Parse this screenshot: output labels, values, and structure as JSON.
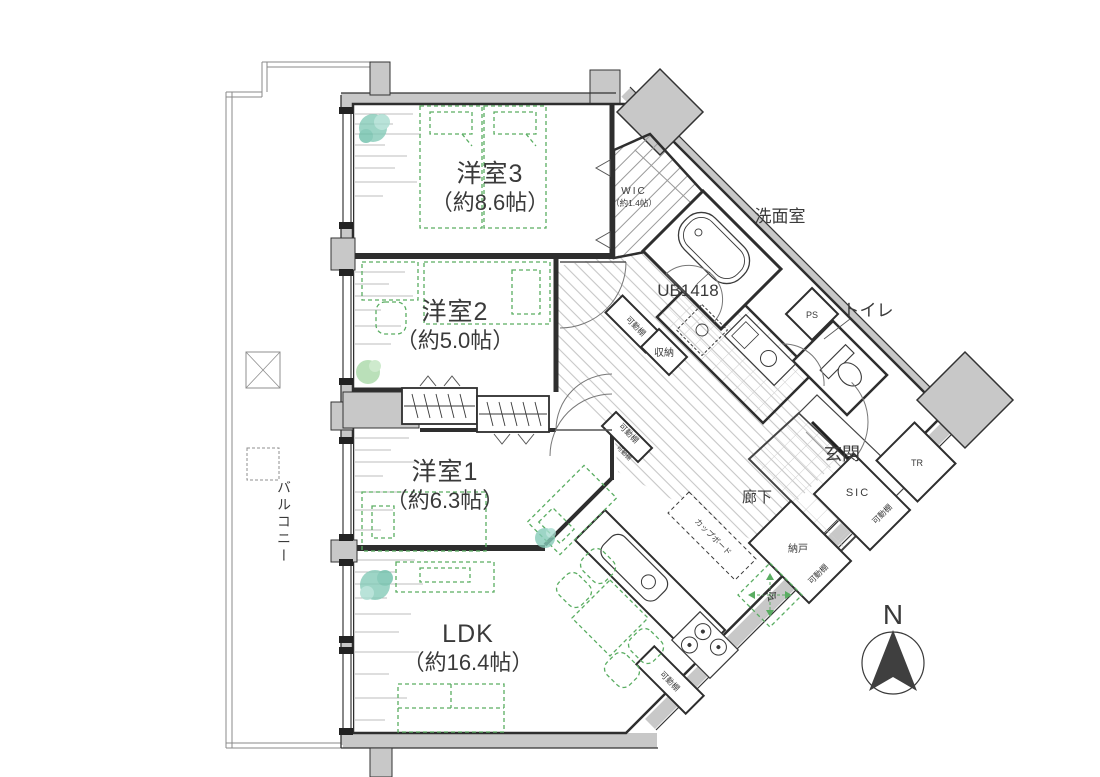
{
  "plan": {
    "rooms": {
      "yoshitsu3": {
        "name": "洋室3",
        "size": "（約8.6帖）"
      },
      "yoshitsu2": {
        "name": "洋室2",
        "size": "（約5.0帖）"
      },
      "yoshitsu1": {
        "name": "洋室1",
        "size": "（約6.3帖）"
      },
      "ldk": {
        "name": "LDK",
        "size": "（約16.4帖）"
      },
      "wic": {
        "name": "WIC",
        "size": "（約1.4帖）"
      },
      "senmenshitsu": {
        "name": "洗面室"
      },
      "bath": {
        "name": "UB1418"
      },
      "toilet": {
        "name": "トイレ"
      },
      "genkan": {
        "name": "玄関"
      },
      "rouka": {
        "name": "廊下"
      },
      "sic": {
        "name": "SIC"
      },
      "nando": {
        "name": "納戸"
      },
      "balcony": {
        "name": "バルコニー"
      }
    },
    "labels": {
      "ps": "PS",
      "tr": "TR",
      "shunou": "収納",
      "kadoudana": "可動棚",
      "cupboard": "カップボード",
      "rei": "冷",
      "north": "N"
    }
  }
}
